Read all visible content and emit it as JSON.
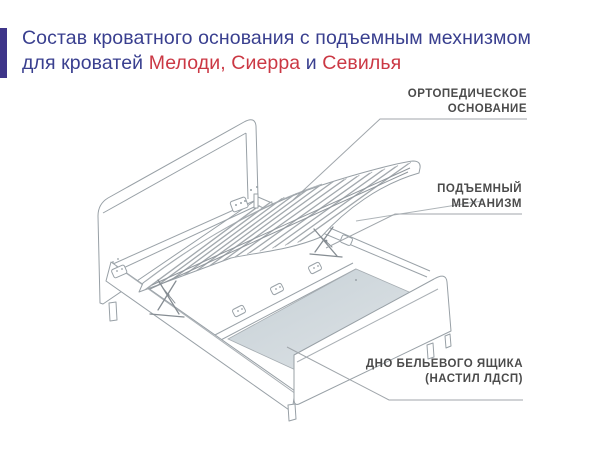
{
  "header": {
    "accent_color": "#3e3589",
    "title_color": "#393f8f",
    "highlight_color": "#cb3844",
    "line1": "Состав кроватного основания с подъемным мехнизмом",
    "line2": {
      "prefix": "для кроватей ",
      "models_1": "Мелоди, Сиерра ",
      "conjunction": "и ",
      "models_2": "Севилья"
    }
  },
  "diagram": {
    "labels": {
      "orthopedic_base": {
        "line1": "ОРТОПЕДИЧЕСКОЕ",
        "line2": "ОСНОВАНИЕ"
      },
      "lift_mechanism": {
        "line1": "ПОДЪЕМНЫЙ",
        "line2": "МЕХАНИЗМ"
      },
      "drawer_bottom": {
        "line1": "ДНО БЕЛЬЕВОГО ЯЩИКА",
        "line2": "(НАСТИЛ ЛДСП)"
      }
    },
    "label_color": "#4b4b4b",
    "line_color": "#98a0a6",
    "pointer_color": "#a0a6ab",
    "panel_fill_top": "#c6d0d6",
    "panel_fill_bottom": "#dfe4e7",
    "slat_count": 13
  }
}
